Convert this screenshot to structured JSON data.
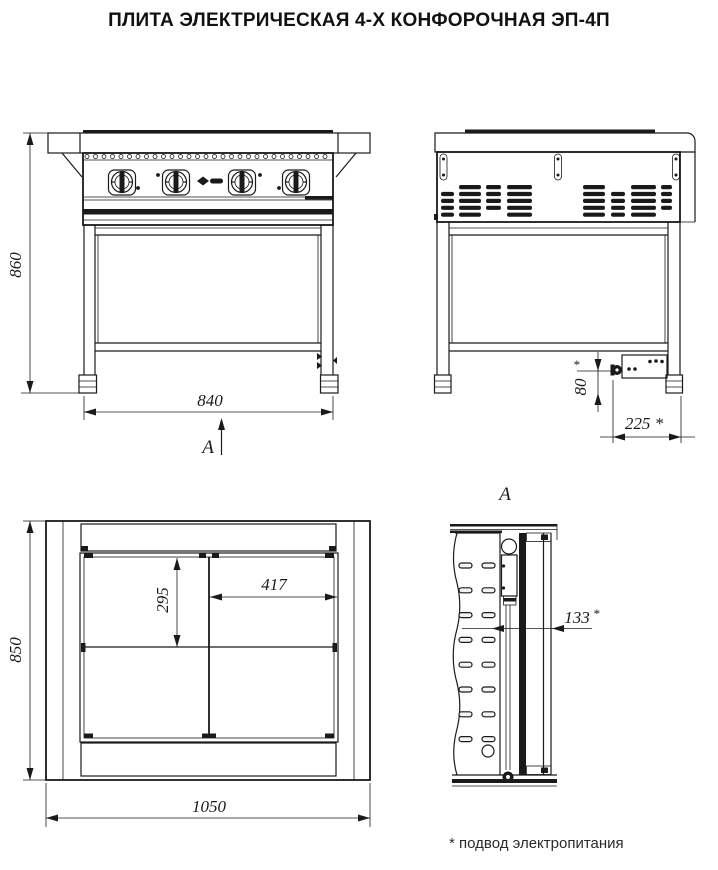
{
  "title": "ПЛИТА ЭЛЕКТРИЧЕСКАЯ 4-Х КОНФОРОЧНАЯ ЭП-4П",
  "footnote": "* подвод электропитания",
  "colors": {
    "line": "#1a1a1a",
    "background": "#ffffff"
  },
  "views": {
    "front": {
      "height_dim": "860",
      "width_dim": "840",
      "arrow_label": "А"
    },
    "side": {
      "cable_height_dim": "80",
      "cable_height_mark": "*",
      "cable_offset_dim": "225 *"
    },
    "plan": {
      "depth_dim": "850",
      "width_dim": "1050",
      "burner_zone_depth_dim": "295",
      "burner_zone_width_dim": "417"
    },
    "section": {
      "label": "А",
      "cable_offset_dim": "133",
      "cable_offset_mark": "*"
    }
  }
}
